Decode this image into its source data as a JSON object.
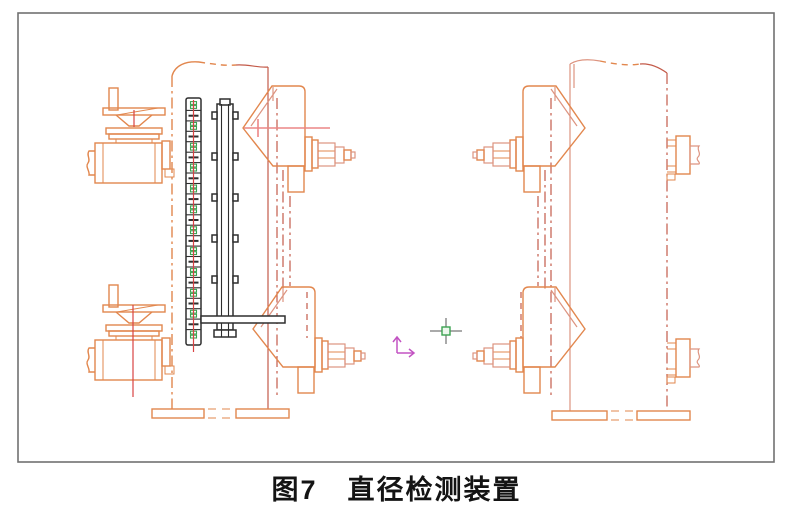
{
  "figure": {
    "number": "图7",
    "title": "直径检测装置"
  },
  "colors": {
    "line-orange": "#E2874E",
    "line-salmon": "#DD9480",
    "line-red": "#C35A49",
    "centerline-red": "#D94343",
    "probe-pink": "#EC8585",
    "dark-line": "#2E2E2E",
    "green-mark": "#3BA351",
    "ucs-magenta": "#C253C2",
    "crosshair-gray": "#8E8E8E",
    "border-gray": "#717171",
    "caption-black": "#141414"
  },
  "ruler": {
    "divisions": 23
  },
  "rail": {
    "tab_rows": 5
  },
  "icons": {
    "ucs": "ucs-xy-axis-icon",
    "cursor": "crosshair-pickbox-icon"
  }
}
